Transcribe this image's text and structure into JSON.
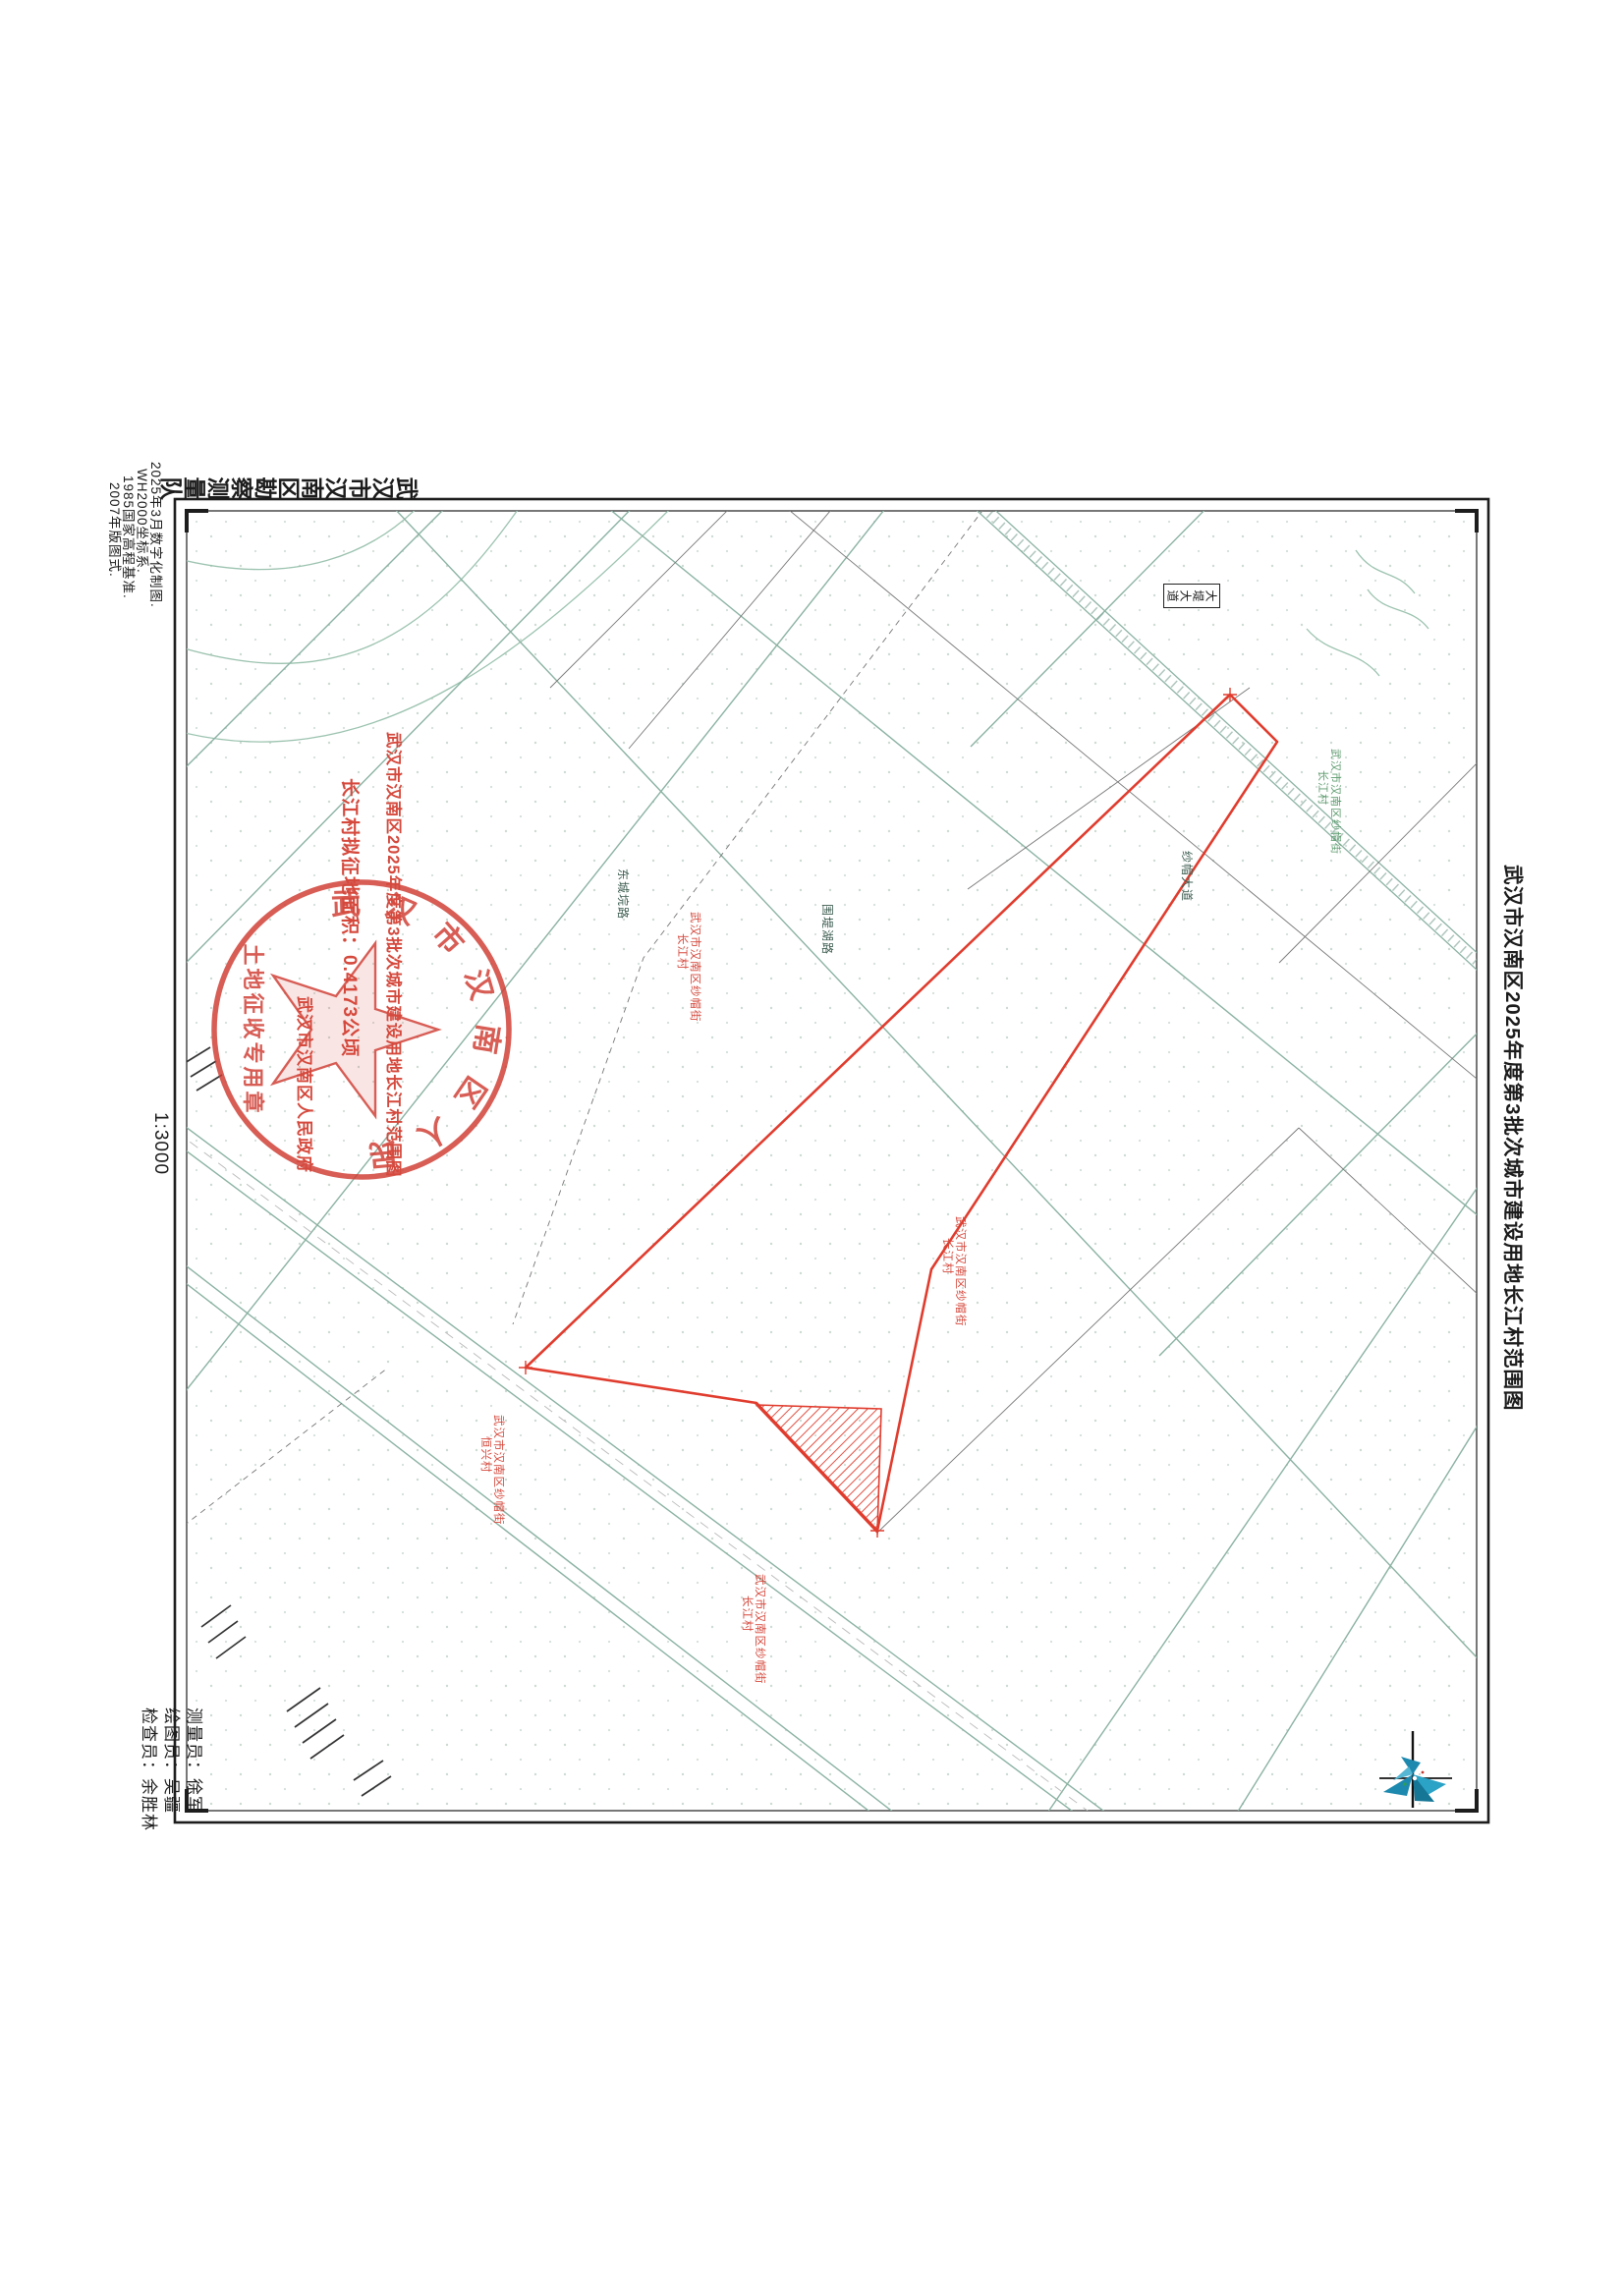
{
  "title": "武汉市汉南区2025年度第3批次城市建设用地长江村范围图",
  "surveyor_org": "武汉市汉南区勘察测量队",
  "map_notes": {
    "line1": "2025年3月数字化制图.",
    "line2": "WH2000坐标系.",
    "line3": "1985国家高程基准.",
    "line4": "2007年版图式."
  },
  "scale": "1:3000",
  "staff": {
    "surveyor": "测量员：徐军",
    "draftsman": "绘图员：吴疆",
    "inspector": "检查员：余胜林"
  },
  "red_annotations": {
    "line1": "武汉市汉南区2025年度第3批次城市建设用地长江村范围图",
    "line2": "长江村拟征地面积：0.4173公顷",
    "line3": "武汉市汉南区人民政府"
  },
  "stamp": {
    "ring_text": "武汉市汉南区人民政府",
    "center_text": "土地征收专用章"
  },
  "road_sign": "大堤大道",
  "road_labels": {
    "a": "东城垸路",
    "b": "围堤湖路",
    "c": "纱帽大道"
  },
  "parcel_labels": [
    {
      "line1": "武汉市汉南区纱帽街",
      "line2": "长江村"
    },
    {
      "line1": "武汉市汉南区纱帽街",
      "line2": "长江村"
    },
    {
      "line1": "武汉市汉南区纱帽街",
      "line2": "恒兴村"
    },
    {
      "line1": "武汉市汉南区纱帽街",
      "line2": "长江村"
    },
    {
      "line1": "武汉市汉南区纱帽街",
      "line2": "长江村"
    }
  ],
  "colors": {
    "boundary_red": "#e03c2e",
    "annotation_red": "#d5493d",
    "stamp_red": "#cf3a30",
    "road_teal": "#8bb2a3",
    "compass_blue": "#1d89ae"
  }
}
